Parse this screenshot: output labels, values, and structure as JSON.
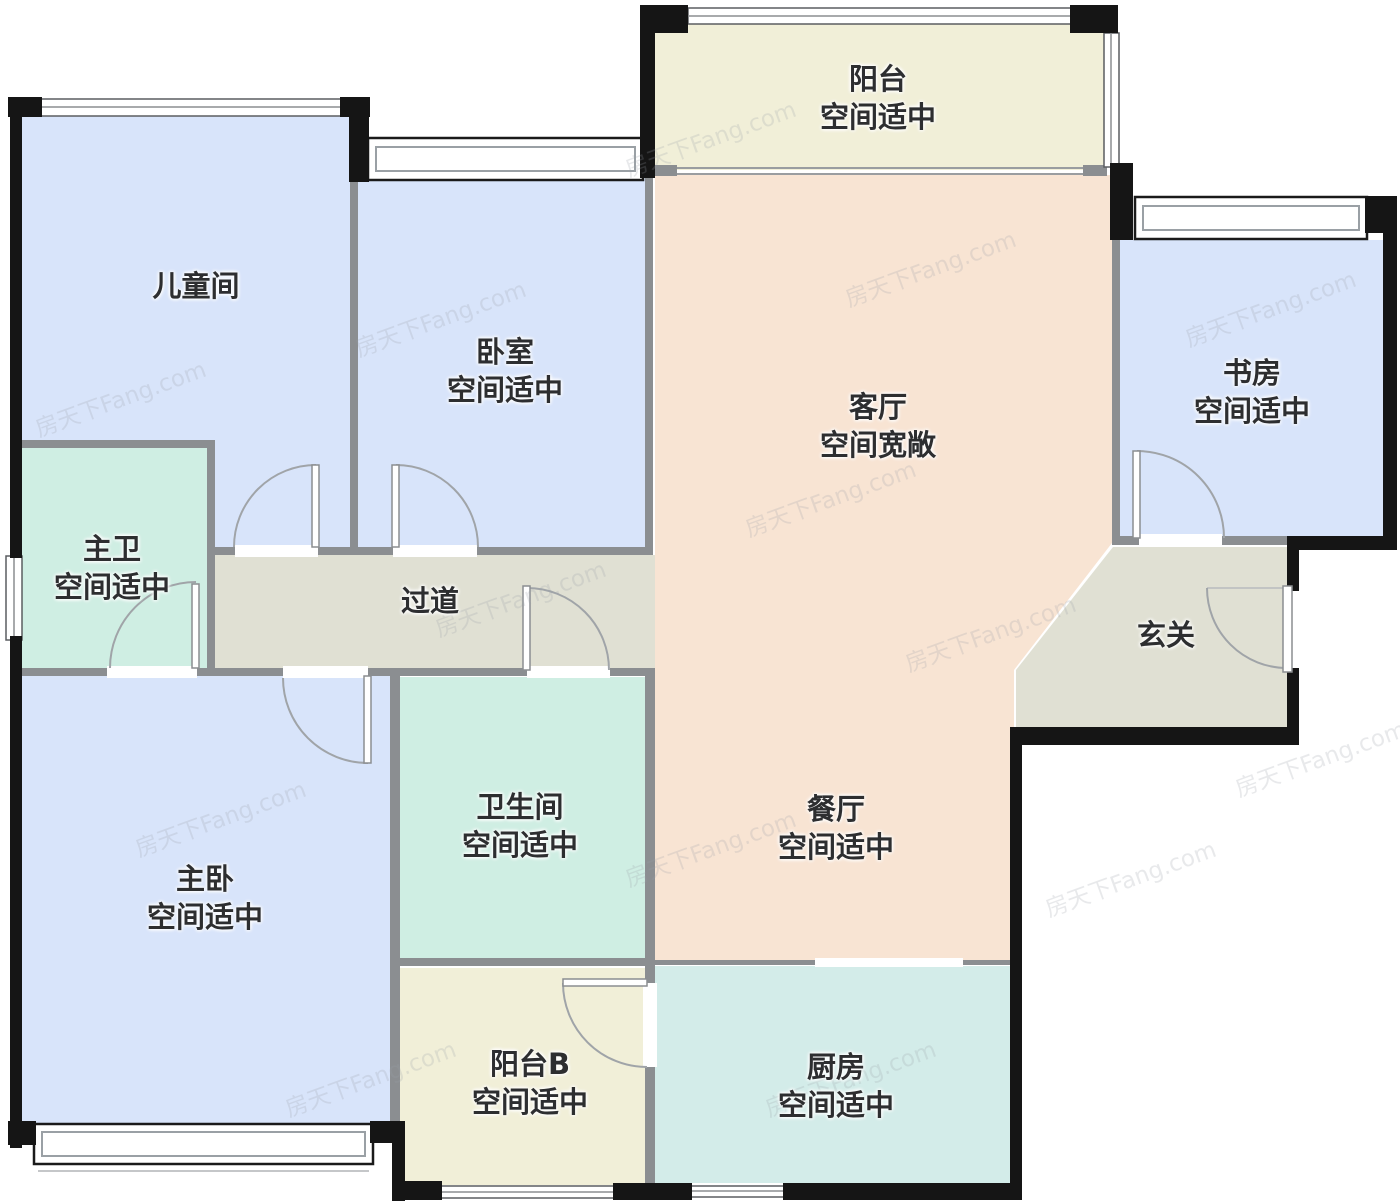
{
  "watermark": {
    "text": "房天下Fang.com"
  },
  "rooms": {
    "children_room": {
      "name": "儿童间",
      "note": ""
    },
    "bedroom": {
      "name": "卧室",
      "note": "空间适中"
    },
    "balcony": {
      "name": "阳台",
      "note": "空间适中"
    },
    "living": {
      "name": "客厅",
      "note": "空间宽敞"
    },
    "study": {
      "name": "书房",
      "note": "空间适中"
    },
    "master_bath": {
      "name": "主卫",
      "note": "空间适中"
    },
    "hallway": {
      "name": "过道",
      "note": ""
    },
    "foyer": {
      "name": "玄关",
      "note": ""
    },
    "master_bedroom": {
      "name": "主卧",
      "note": "空间适中"
    },
    "bathroom": {
      "name": "卫生间",
      "note": "空间适中"
    },
    "dining": {
      "name": "餐厅",
      "note": "空间适中"
    },
    "balcony_b": {
      "name": "阳台B",
      "note": "空间适中"
    },
    "kitchen": {
      "name": "厨房",
      "note": "空间适中"
    }
  },
  "colors": {
    "bedroom_fill": "#d8e4fa",
    "bath_fill": "#cfeee3",
    "kitchen_fill": "#d3ece9",
    "balcony_fill": "#f1efd8",
    "living_fill": "#f8e4d3",
    "hall_fill": "#e0e0d3",
    "exterior_wall": "#151515",
    "interior_wall": "#8b8e91",
    "label_text": "#2d2e30"
  }
}
